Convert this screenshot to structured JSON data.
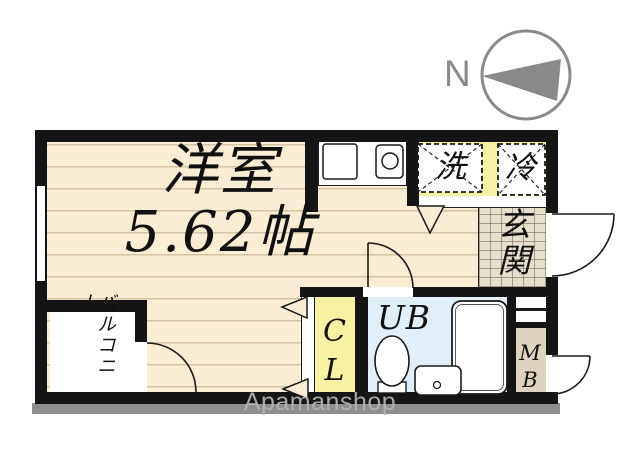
{
  "compass": {
    "north_label": "N"
  },
  "watermark": "Apamanshop",
  "plan": {
    "main_room": {
      "name": "洋室",
      "area": "5.62帖"
    },
    "balcony": "バルコニー",
    "entrance": "玄関",
    "closet": "CL",
    "unit_bath": "UB",
    "meter_box": "MB",
    "washing_machine": "洗",
    "refrigerator": "冷"
  },
  "colors": {
    "wall": "#151515",
    "floor_cream": "#f9edd6",
    "accent_yellow": "#f5f1a5",
    "bath_blue": "#e1f0f8",
    "tile_beige": "#e7dfce",
    "meter_tan": "#ddd3c0",
    "compass_gray": "#8a8a8a"
  }
}
